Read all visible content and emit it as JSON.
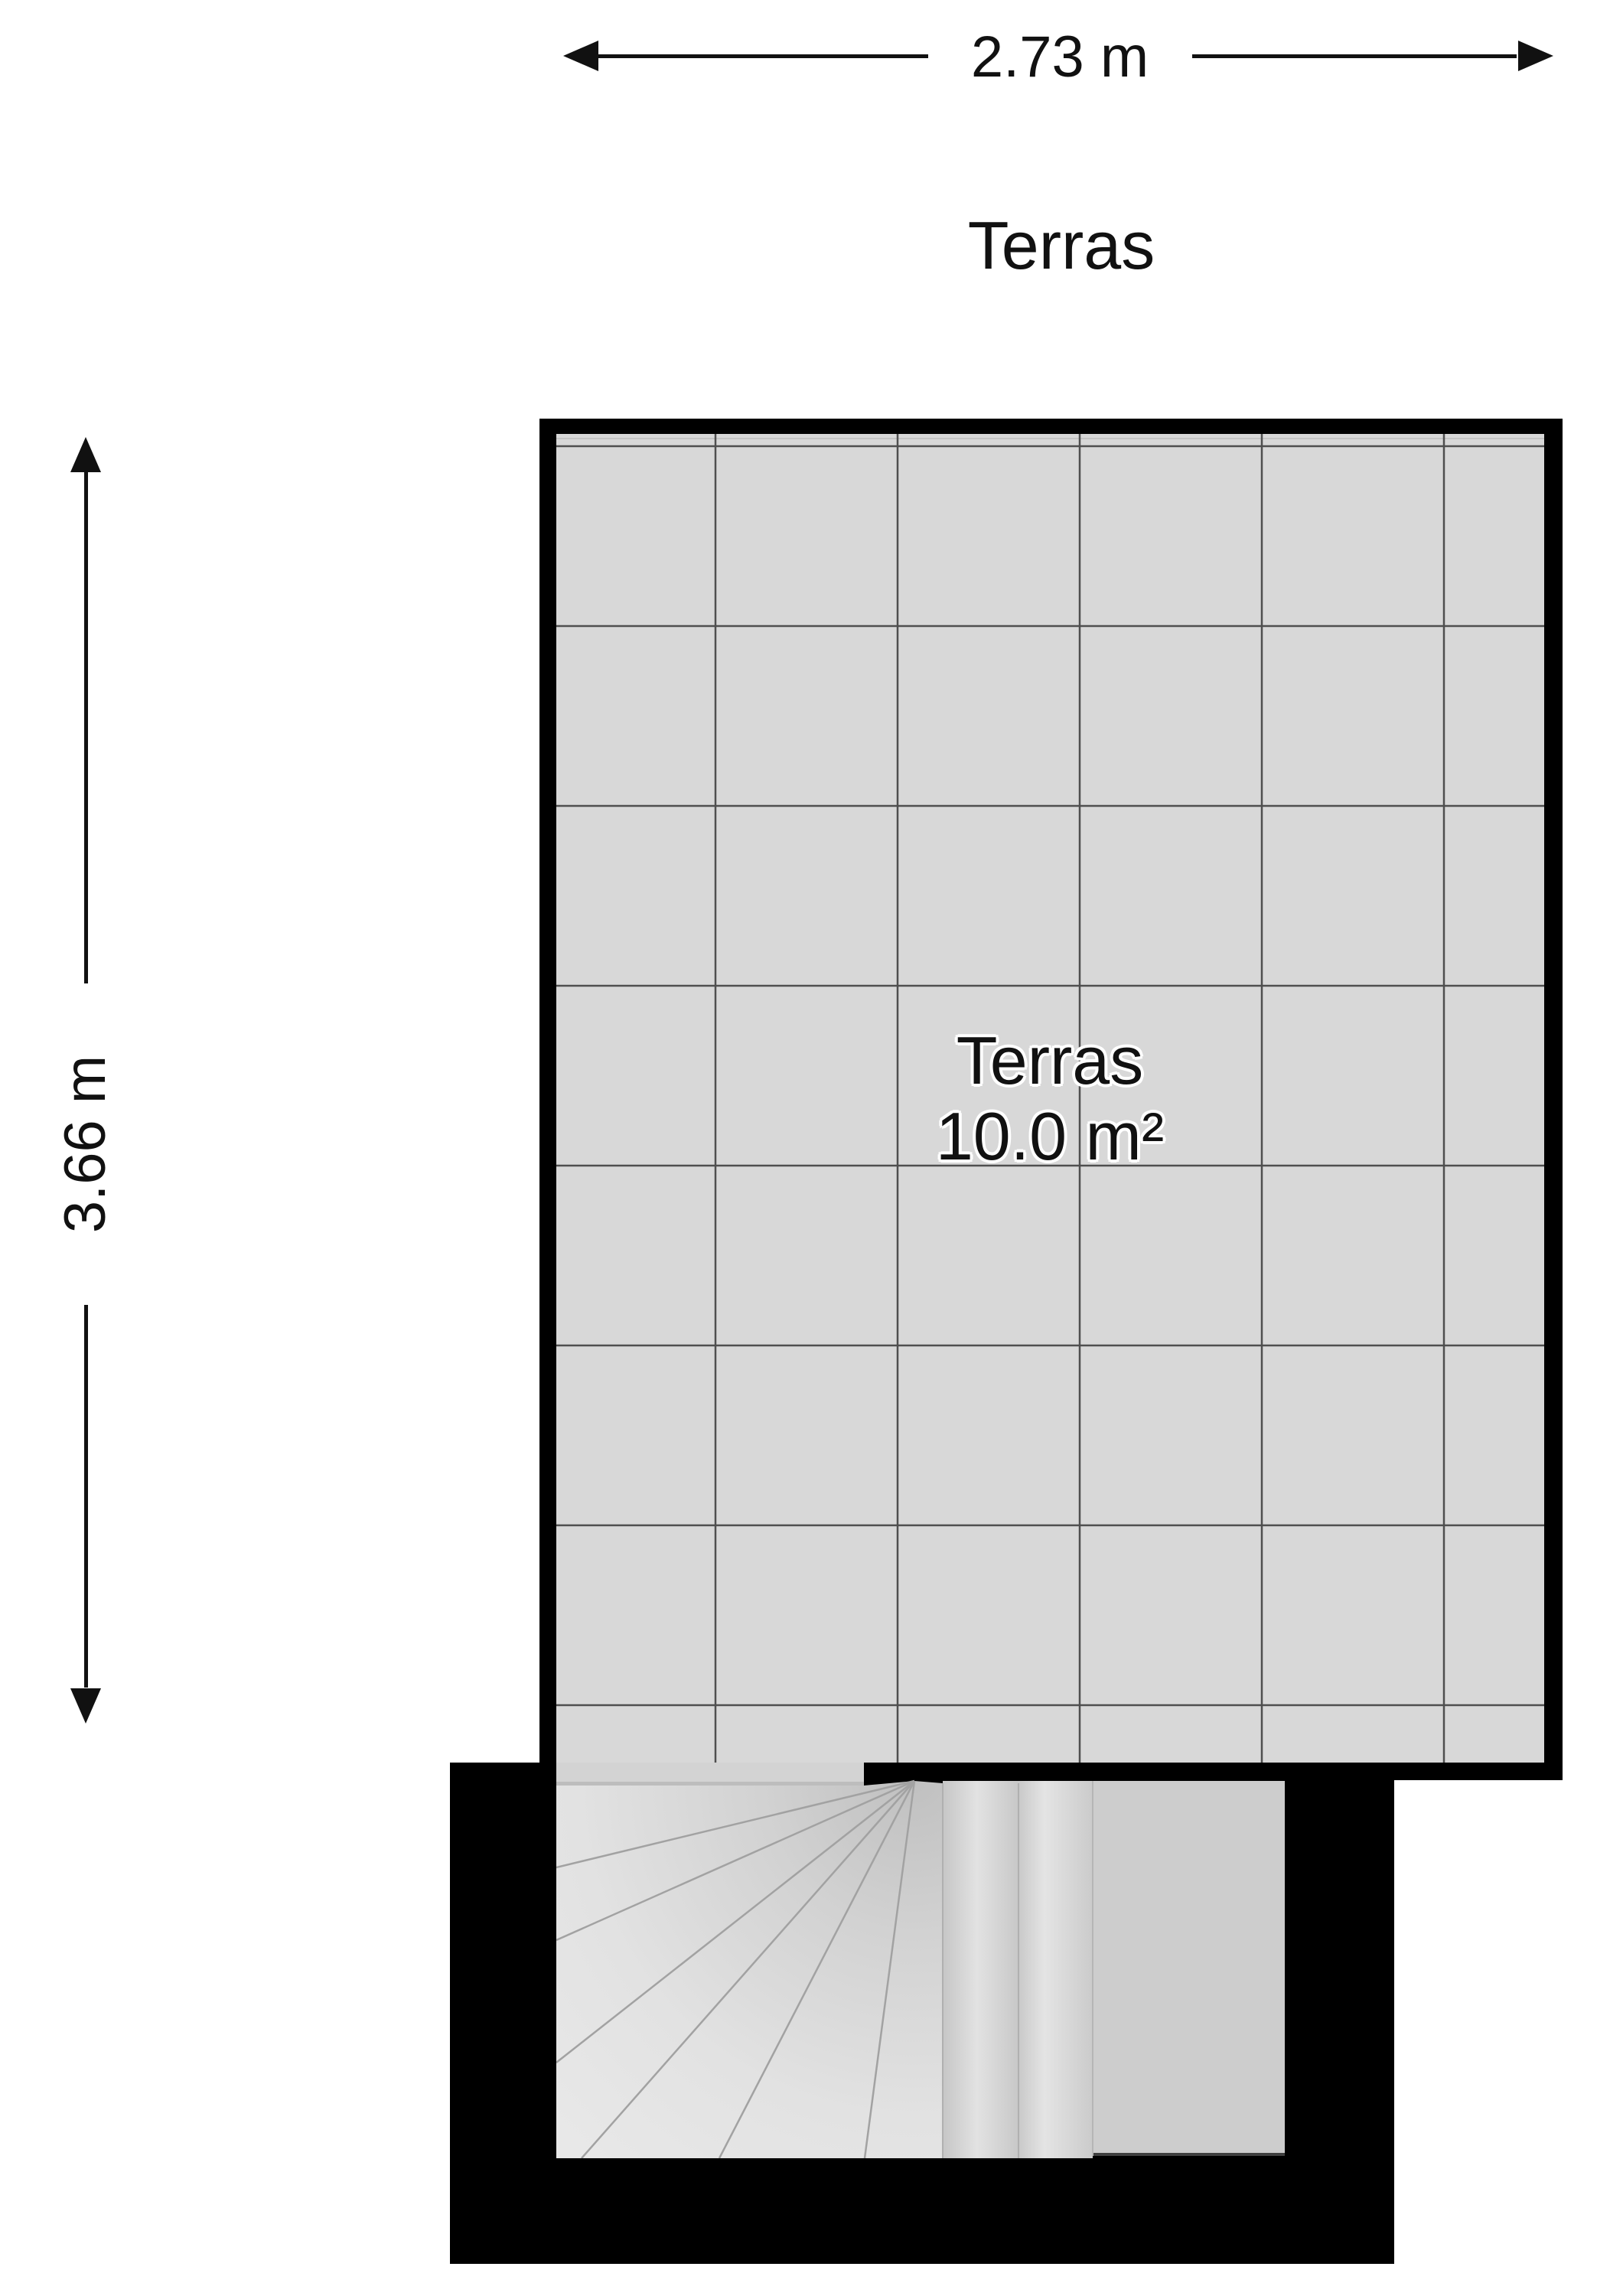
{
  "floor_plan": {
    "title": "Terras",
    "room": {
      "name": "Terras",
      "area": "10.0 m²"
    },
    "dimensions": {
      "width_label": "2.73 m",
      "height_label": "3.66 m"
    }
  },
  "theme": {
    "wall": "#000000",
    "floor": "#d8d8d8",
    "grid_line": "#4f4f4f",
    "landing": "#cdcdcd",
    "tread_light": "#e7e7e7",
    "tread_dark": "#c0c0c0",
    "text": "#111111"
  }
}
